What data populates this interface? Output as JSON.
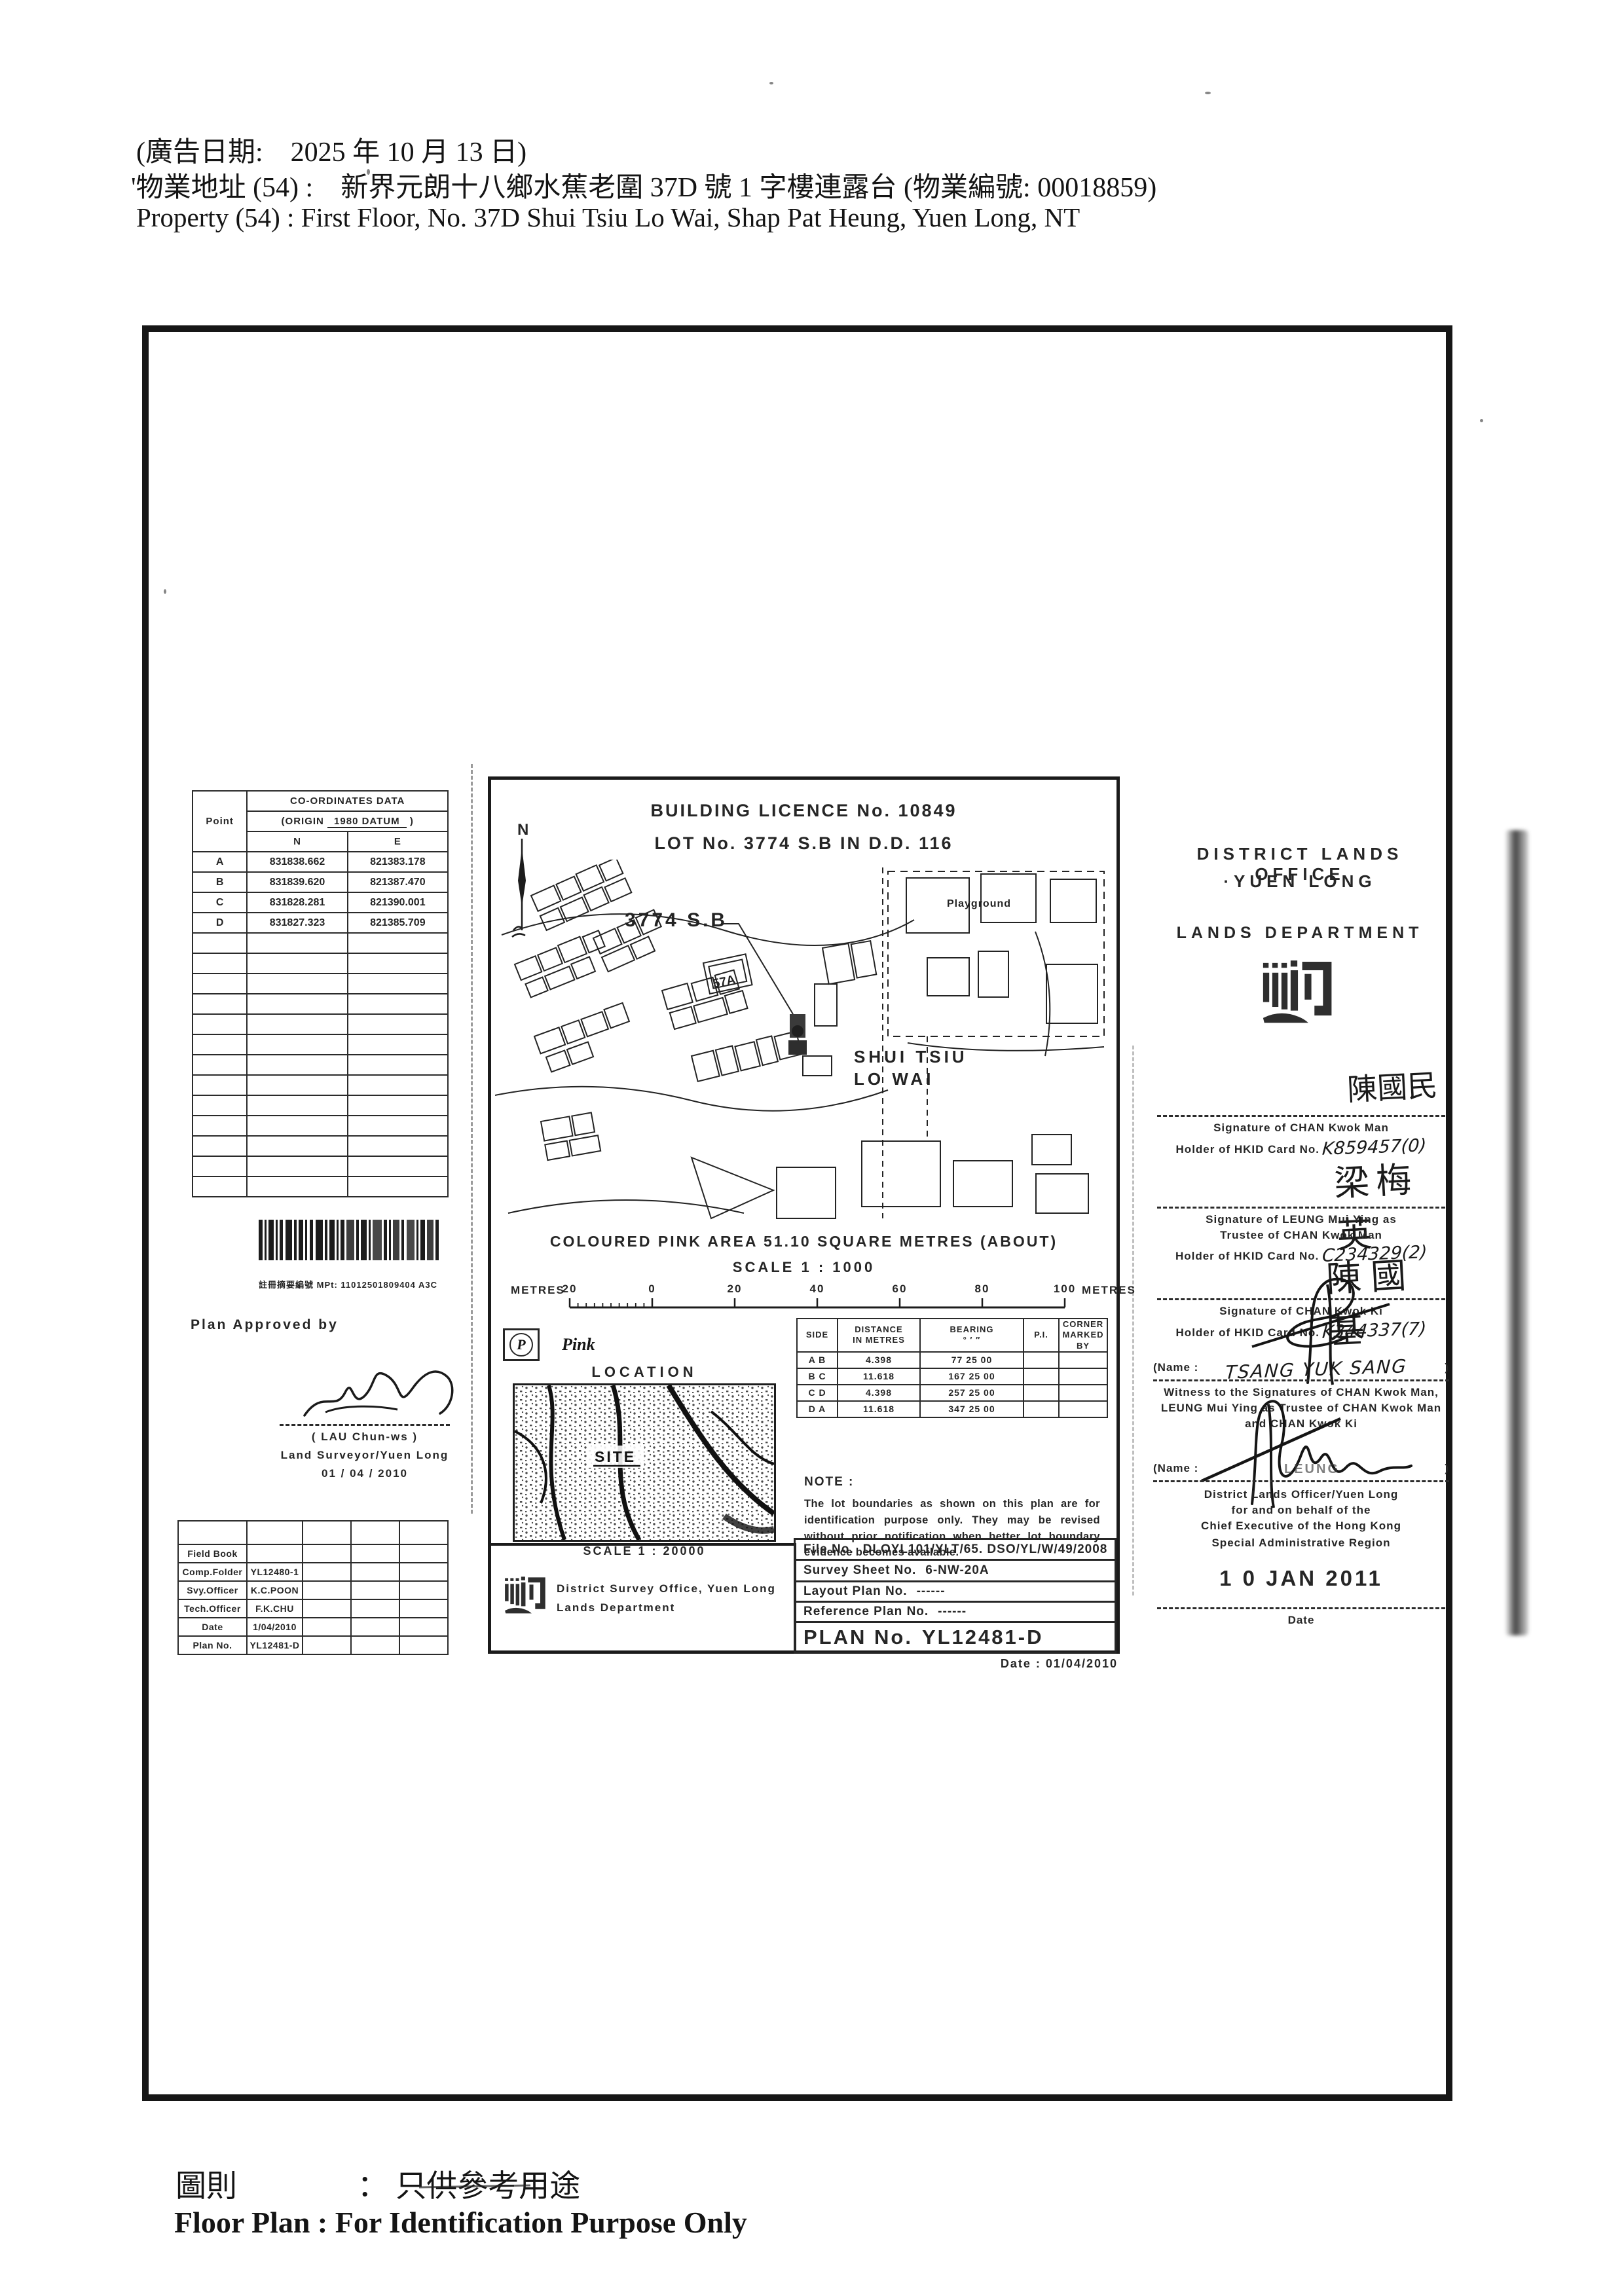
{
  "colors": {
    "paper": "#ffffff",
    "ink": "#1f1f1f",
    "stamp_ink": "#262626"
  },
  "header": {
    "ad_date_line": "(廣告日期:　2025 年 10 月 13 日)",
    "property_line_zh": "'物業地址 (54) :　新界元朗十八鄉水蕉老圍 37D 號 1 字樓連露台 (物業編號: 00018859)",
    "property_line_en": "Property    (54) :    First Floor, No. 37D Shui Tsiu Lo Wai, Shap Pat Heung, Yuen Long, NT"
  },
  "footer": {
    "caption_zh_label": "圖則",
    "caption_zh_sep": "：",
    "caption_zh_value": "只供參考用途",
    "caption_en": "Floor Plan : For Identification Purpose Only"
  },
  "left_panel": {
    "coordinates_table": {
      "col_point": "Point",
      "title": "CO-ORDINATES  DATA",
      "origin_prefix": "(ORIGIN",
      "origin_value": "1980 DATUM",
      "origin_suffix": ")",
      "col_n": "N",
      "col_e": "E",
      "rows": [
        {
          "point": "A",
          "n": "831838.662",
          "e": "821383.178"
        },
        {
          "point": "B",
          "n": "831839.620",
          "e": "821387.470"
        },
        {
          "point": "C",
          "n": "831828.281",
          "e": "821390.001"
        },
        {
          "point": "D",
          "n": "831827.323",
          "e": "821385.709"
        }
      ]
    },
    "barcode_label": "註冊摘要編號 MPt: 11012501809404   A3C",
    "approval": {
      "label": "Plan Approved by",
      "name": "(  LAU  Chun-ws  )",
      "title": "Land Surveyor/Yuen Long",
      "date": "01 / 04 / 2010"
    },
    "fieldbook": {
      "rows": [
        {
          "label": "Field Book",
          "value": ""
        },
        {
          "label": "Comp.Folder",
          "value": "YL12480-1"
        },
        {
          "label": "Svy.Officer",
          "value": "K.C.POON"
        },
        {
          "label": "Tech.Officer",
          "value": "F.K.CHU"
        },
        {
          "label": "Date",
          "value": "1/04/2010"
        },
        {
          "label": "Plan No.",
          "value": "YL12481-D"
        }
      ]
    }
  },
  "plan": {
    "title_line1": "BUILDING    LICENCE    No.    10849",
    "title_line2": "LOT    No.    3774  S.B    IN    D.D.    116",
    "north_label": "N",
    "map_labels": {
      "lot": "3774 S.B",
      "lot_sub": "57A",
      "village_line1": "SHUI  TSIU",
      "village_line2": "LO  WAI",
      "playground": "Playground"
    },
    "area_line": "COLOURED   PINK   AREA   51.10   SQUARE   METRES   (ABOUT)",
    "scale_line": "SCALE   1  :  1000",
    "scalebar": {
      "left_label": "METRES",
      "ticks": [
        "20",
        "0",
        "20",
        "40",
        "60",
        "80",
        "100"
      ],
      "right_label": "METRES"
    },
    "legend": {
      "symbol": "P",
      "label": "Pink"
    },
    "location": {
      "title": "LOCATION",
      "site_label": "SITE",
      "scale": "SCALE 1 : 20000"
    },
    "sides_table": {
      "headers": {
        "side": "SIDE",
        "distance1": "DISTANCE",
        "distance2": "IN METRES",
        "bearing1": "BEARING",
        "bearing2": "°   ′   ″",
        "pi": "P.I.",
        "corner1": "CORNER",
        "corner2": "MARKED BY"
      },
      "rows": [
        {
          "side": "A B",
          "distance": "4.398",
          "bearing": "77 25 00",
          "pi": "",
          "corner": ""
        },
        {
          "side": "B C",
          "distance": "11.618",
          "bearing": "167 25 00",
          "pi": "",
          "corner": ""
        },
        {
          "side": "C D",
          "distance": "4.398",
          "bearing": "257 25 00",
          "pi": "",
          "corner": ""
        },
        {
          "side": "D A",
          "distance": "11.618",
          "bearing": "347 25 00",
          "pi": "",
          "corner": ""
        }
      ]
    },
    "note": {
      "label": "NOTE :",
      "text": "The lot boundaries as shown on this plan are for identification purpose only.   They may be revised without prior notification when better lot boundary evidence becomes available."
    },
    "refs": {
      "file": {
        "label": "File No.",
        "value": "DLOYL101/YLT/65. DSO/YL/W/49/2008"
      },
      "survey_sheet": {
        "label": "Survey Sheet No.",
        "value": "6-NW-20A"
      },
      "layout": {
        "label": "Layout Plan No.",
        "value": "------"
      },
      "reference": {
        "label": "Reference Plan No.",
        "value": "------"
      },
      "plan_no": {
        "label": "PLAN No.",
        "value": "YL12481-D"
      }
    },
    "office": {
      "line1": "District Survey Office, Yuen Long",
      "line2": "Lands Department"
    },
    "date": {
      "label": "Date :",
      "value": "01/04/2010"
    }
  },
  "right_panel": {
    "office_line1": "DISTRICT LANDS OFFICE",
    "office_line2": "·YUEN LONG",
    "department": "LANDS DEPARTMENT",
    "signatures": [
      {
        "handwritten": "陳國民",
        "caption1": "Signature of CHAN Kwok Man",
        "holder_label": "Holder of HKID Card No.",
        "card_no": "K859457(0)"
      },
      {
        "handwritten": "梁梅英",
        "caption1": "Signature of LEUNG Mui Ying as",
        "caption2": "Trustee of CHAN Kwok Man",
        "holder_label": "Holder of HKID Card No.",
        "card_no": "C234329(2)"
      },
      {
        "handwritten": "陳國基",
        "caption1": "Signature of CHAN Kwok Ki",
        "holder_label": "Holder of HKID Card No.",
        "card_no": "K344337(7)"
      }
    ],
    "witness": {
      "name_label": "(Name :",
      "name_value": "TSANG YUK SANG",
      "name_close": ")",
      "line1": "Witness to the Signatures of CHAN Kwok Man,",
      "line2": "LEUNG Mui Ying as Trustee of CHAN Kwok Man",
      "line3": "and CHAN Kwok Ki"
    },
    "officer": {
      "name_label": "(Name :",
      "name_stamp": "LEUNG",
      "name_close": ")",
      "line1": "District Lands Officer/Yuen Long",
      "line2": "for and on behalf of the",
      "line3": "Chief Executive of the Hong Kong",
      "line4": "Special Administrative Region"
    },
    "date_stamp": "1 0 JAN 2011",
    "date_label": "Date"
  }
}
